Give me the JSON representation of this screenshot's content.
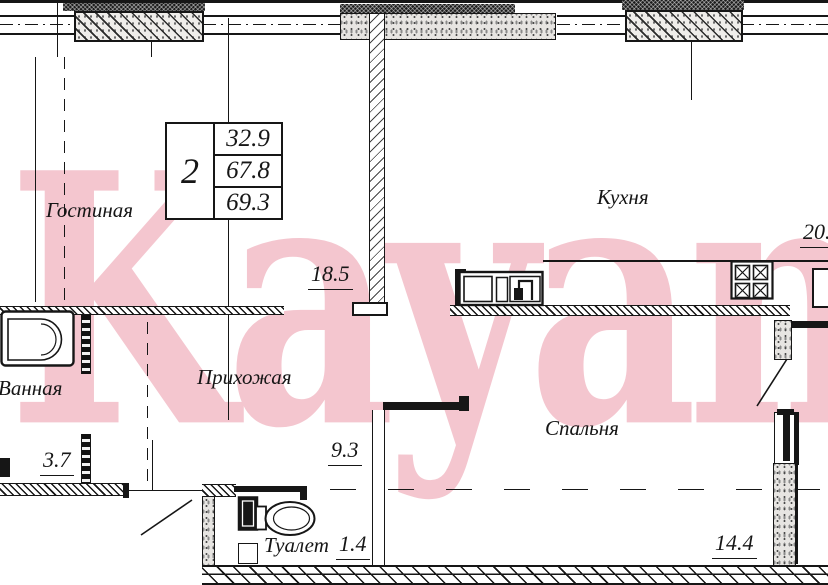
{
  "watermark": {
    "text": "Kayan",
    "color": "#f4c6cf"
  },
  "stamp": {
    "rooms_count": "2",
    "area_living": "32.9",
    "area_total": "67.8",
    "area_overall": "69.3"
  },
  "rooms": {
    "living": {
      "label": "Гостиная",
      "area": "18.5"
    },
    "kitchen": {
      "label": "Кухня",
      "area": "20.5"
    },
    "hall": {
      "label": "Прихожая",
      "area": "9.3"
    },
    "bath": {
      "label": "Ванная",
      "area": "3.7"
    },
    "wc": {
      "label": "Туалет",
      "area": "1.4"
    },
    "bedroom": {
      "label": "Спальня",
      "area": "14.4"
    }
  }
}
